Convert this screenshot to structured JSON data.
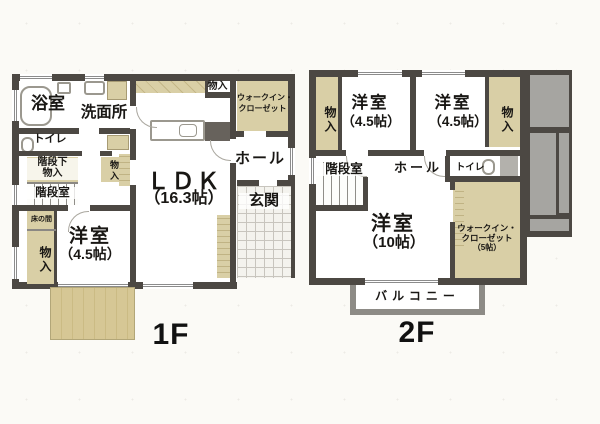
{
  "palette": {
    "wall": "#4c4843",
    "closet_tan": "#d9cfa6",
    "deck_wood": "#d6c795",
    "roof_gray": "#a6a5a1",
    "balcony_wall": "#8d8b86",
    "paper": "#fbfaf6",
    "text": "#191714"
  },
  "floor1": {
    "label": "1F",
    "bathroom": "浴室",
    "washroom": "洗面所",
    "toilet": "トイレ",
    "understair_line1": "階段下",
    "understair_line2": "物入",
    "stairwell": "階段室",
    "tokonoma": "床の間",
    "closet_left": "物入",
    "closet_mid": "物入",
    "closet_top": "物入",
    "western_room": "洋室",
    "western_room_size": "（4.5帖）",
    "ldk": "ＬＤＫ",
    "ldk_size": "（16.3帖）",
    "wic_line1": "ウォークイン・",
    "wic_line2": "クローゼット",
    "hall": "ホール",
    "entrance": "玄関"
  },
  "floor2": {
    "label": "2F",
    "closet_left": "物入",
    "room_a": "洋室",
    "room_a_size": "（4.5帖）",
    "room_b": "洋室",
    "room_b_size": "（4.5帖）",
    "closet_right": "物入",
    "stairwell": "階段室",
    "hall": "ホール",
    "toilet": "トイレ",
    "room_c": "洋室",
    "room_c_size": "（10帖）",
    "wic_line1": "ウォークイン・",
    "wic_line2": "クローゼット",
    "wic_size": "（5帖）",
    "balcony": "バルコニー"
  }
}
